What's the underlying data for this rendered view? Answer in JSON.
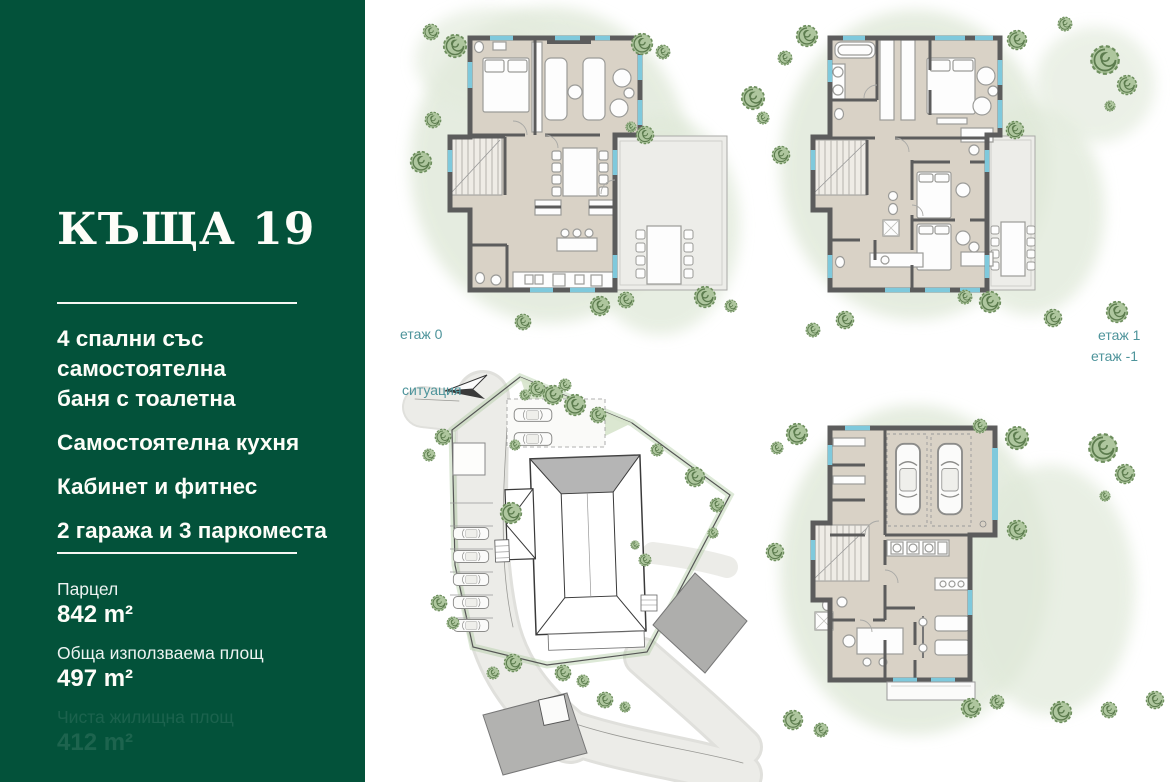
{
  "sidebar": {
    "title": "КЪЩА 19",
    "features": [
      "4 спални със\nсамостоятелна\nбаня с тоалетна",
      "Самостоятелна кухня",
      "Кабинет и фитнес",
      "2 гаража и 3 паркоместа"
    ],
    "stats": [
      {
        "label": "Парцел",
        "value": "842 m²"
      },
      {
        "label": "Обща използваема площ",
        "value": "497 m²"
      },
      {
        "label": "Чиста жилищна площ",
        "value": "412 m²"
      }
    ]
  },
  "plans": {
    "floor0": {
      "label": "етаж 0"
    },
    "floor1": {
      "label": "етаж 1"
    },
    "site": {
      "label": "ситуация"
    },
    "basement": {
      "label": "етаж -1"
    }
  },
  "colors": {
    "sidebar_green": "#03523A",
    "plan_label_teal": "#4E949B",
    "wall_gray": "#5C5C5C",
    "floor_beige": "#D9D2C6",
    "terrace_gray": "#EDEDE9",
    "window_blue": "#7FC9DC",
    "tree_green": "#6E8F5E",
    "wash_green": "#E3EBDD",
    "neighbor_building_gray": "#AEAEAC"
  }
}
